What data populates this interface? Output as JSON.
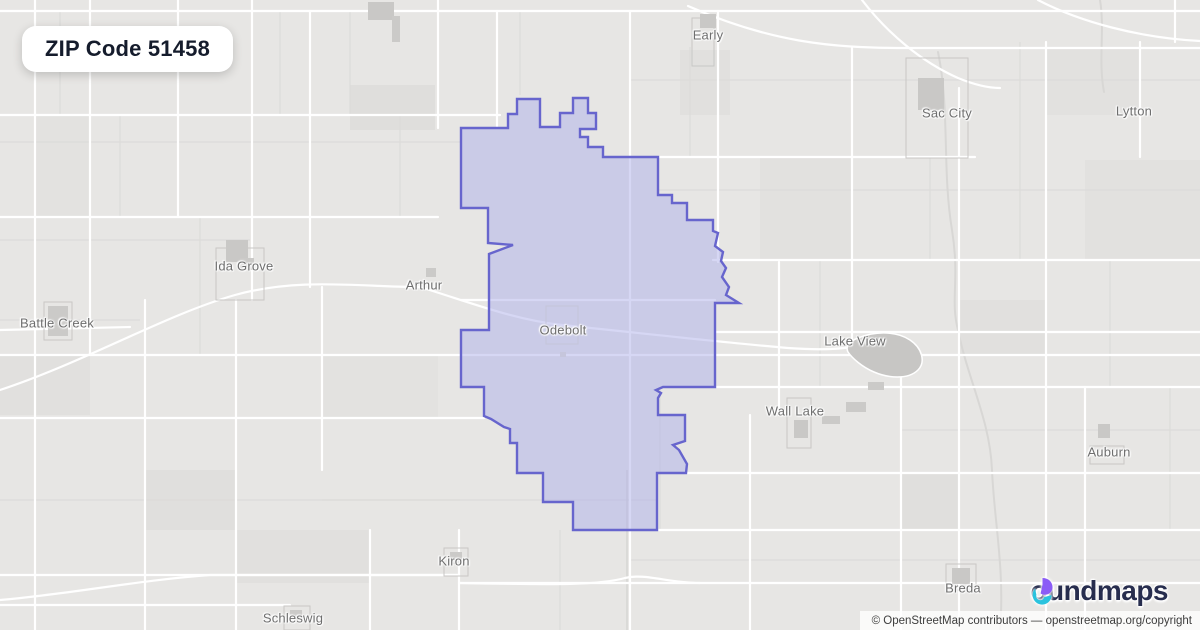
{
  "badge": {
    "title": "ZIP Code 51458"
  },
  "map": {
    "boundary_name": "ZIP 51458 boundary (Odebolt, IA area)",
    "boundary_color": "#6765cd",
    "boundary_fill": "rgba(173,176,233,0.5)",
    "boundary_path": "M461,128 L508,128 L508,114 L517,114 L517,99 L540,99 L540,127 L560,127 L560,113 L573,113 L573,98 L588,98 L588,113 L596,113 L596,129 L580,129 L580,137 L588,137 L588,147 L603,147 L603,157 L658,157 L658,195 L672,195 L672,203 L687,203 L687,220 L713,220 L713,231 L718,233 L715,246 L723,252 L721,261 L726,268 L722,277 L729,287 L726,295 L739,303 L715,303 L715,387 L663,387 L656,390 L661,393 L658,398 L658,415 L685,415 L685,441 L673,445 L679,450 L687,464 L686,473 L657,473 L657,530 L573,530 L573,502 L543,502 L543,473 L517,473 L517,443 L510,443 L510,429 L504,427 L491,419 L484,416 L484,387 L461,387 L461,330 L489,330 L489,254 L513,245 L488,243 L488,208 L461,208 Z",
    "towns": [
      {
        "name": "Early",
        "x": 708,
        "y": 35
      },
      {
        "name": "Sac City",
        "x": 947,
        "y": 113
      },
      {
        "name": "Lytton",
        "x": 1134,
        "y": 111
      },
      {
        "name": "Ida Grove",
        "x": 244,
        "y": 266
      },
      {
        "name": "Arthur",
        "x": 424,
        "y": 285
      },
      {
        "name": "Battle Creek",
        "x": 57,
        "y": 323
      },
      {
        "name": "Odebolt",
        "x": 563,
        "y": 330
      },
      {
        "name": "Lake View",
        "x": 855,
        "y": 341
      },
      {
        "name": "Wall Lake",
        "x": 795,
        "y": 411
      },
      {
        "name": "Auburn",
        "x": 1109,
        "y": 452
      },
      {
        "name": "Kiron",
        "x": 454,
        "y": 561
      },
      {
        "name": "Breda",
        "x": 963,
        "y": 588
      },
      {
        "name": "Schleswig",
        "x": 293,
        "y": 618
      }
    ]
  },
  "logo": {
    "name": "boundmaps",
    "wordmark_suffix": "oundmaps",
    "color_dark": "#272d4e",
    "color_purple": "#8b5cf6",
    "color_teal": "#2bc3de"
  },
  "attribution": {
    "text": "© OpenStreetMap contributors — openstreetmap.org/copyright"
  }
}
